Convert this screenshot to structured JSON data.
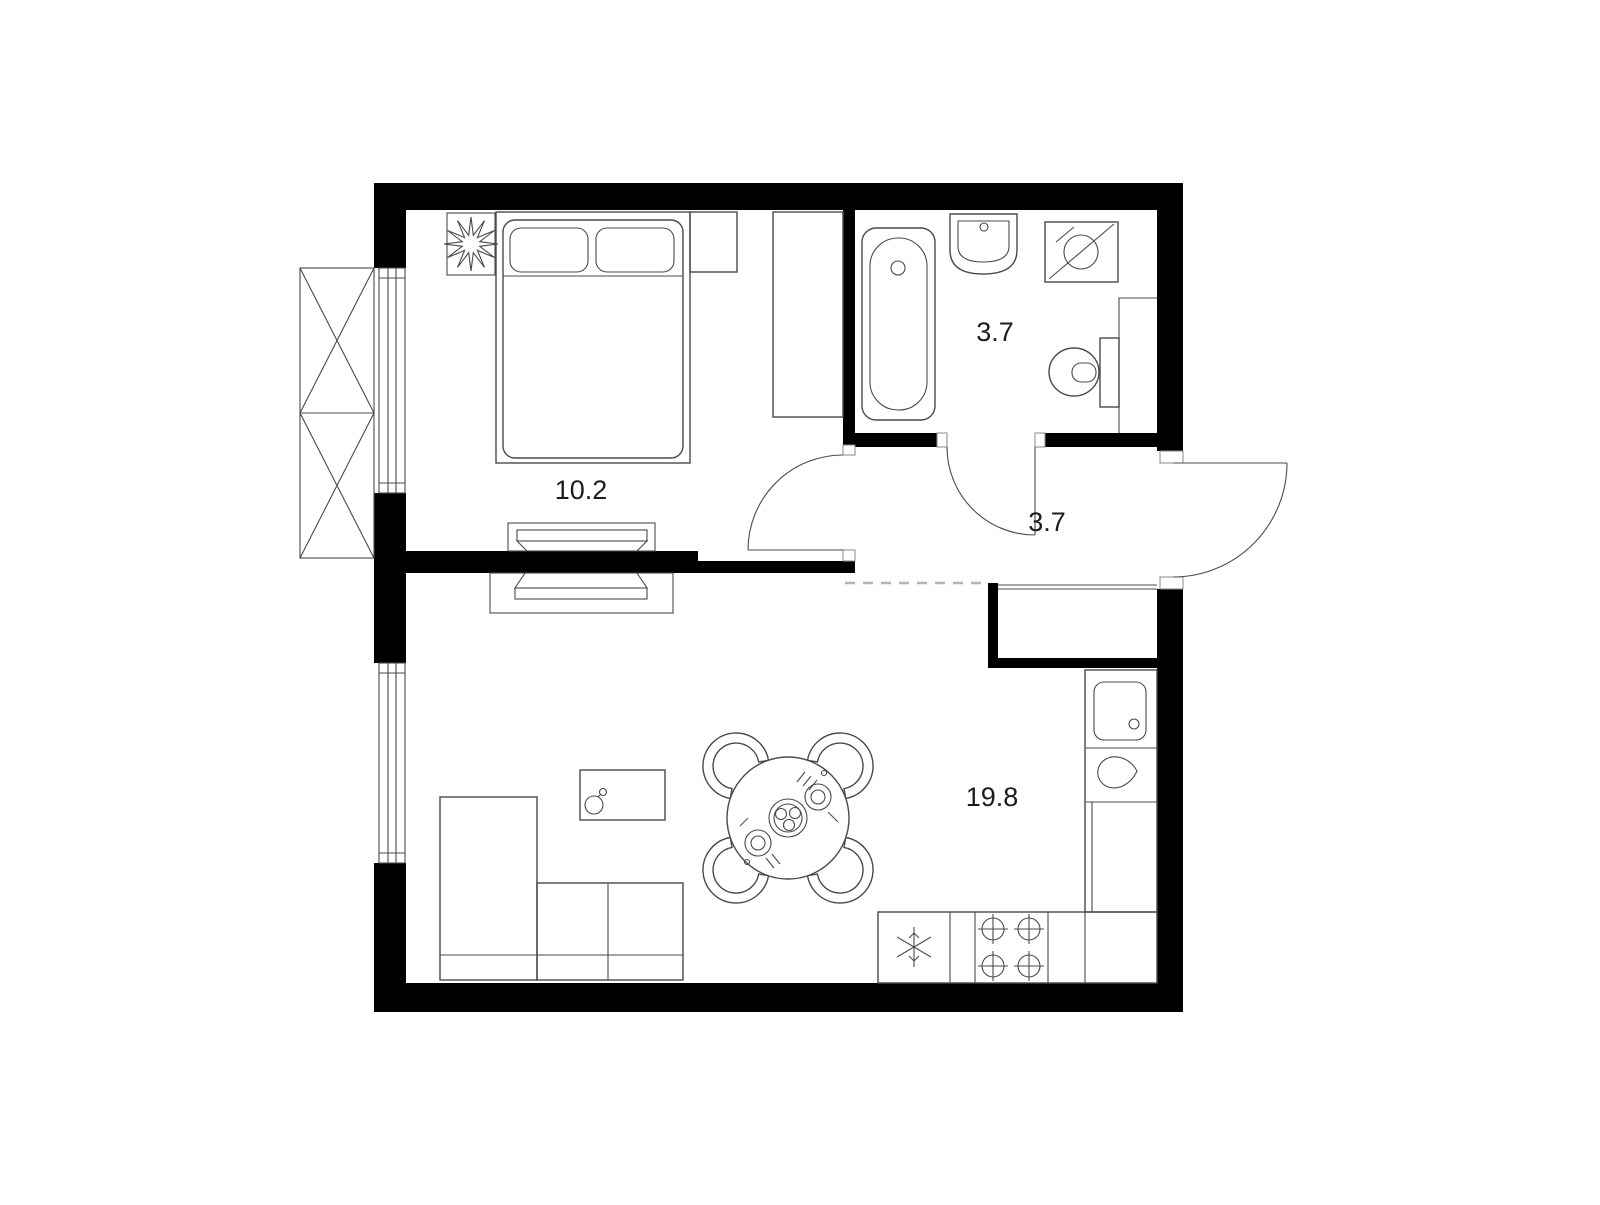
{
  "plan": {
    "type": "apartment-floor-plan",
    "rooms": [
      {
        "id": "bedroom",
        "area": "10.2"
      },
      {
        "id": "bathroom",
        "area": "3.7"
      },
      {
        "id": "hallway",
        "area": "3.7"
      },
      {
        "id": "living-kitchen",
        "area": "19.8"
      }
    ],
    "fixtures": {
      "bedroom": [
        "plant",
        "double-bed",
        "pillows",
        "bedside-shelf",
        "wardrobe",
        "tv-unit",
        "window"
      ],
      "bathroom": [
        "bathtub",
        "washbasin",
        "washing-machine",
        "toilet",
        "service-niche"
      ],
      "hallway": [
        "bedroom-door",
        "bathroom-door",
        "entrance-door",
        "closet"
      ],
      "living-kitchen": [
        "tv-unit",
        "corner-sofa",
        "coffee-table",
        "dining-table",
        "chairs",
        "kitchen-sink",
        "faucet-drop",
        "fridge",
        "stove",
        "counters",
        "window",
        "balcony-shaft"
      ]
    },
    "colors": {
      "wall": "#000000",
      "line": "#4a4a4a",
      "label": "#1c1c1c",
      "background": "#ffffff",
      "dashed": "#b5b5b5"
    }
  }
}
